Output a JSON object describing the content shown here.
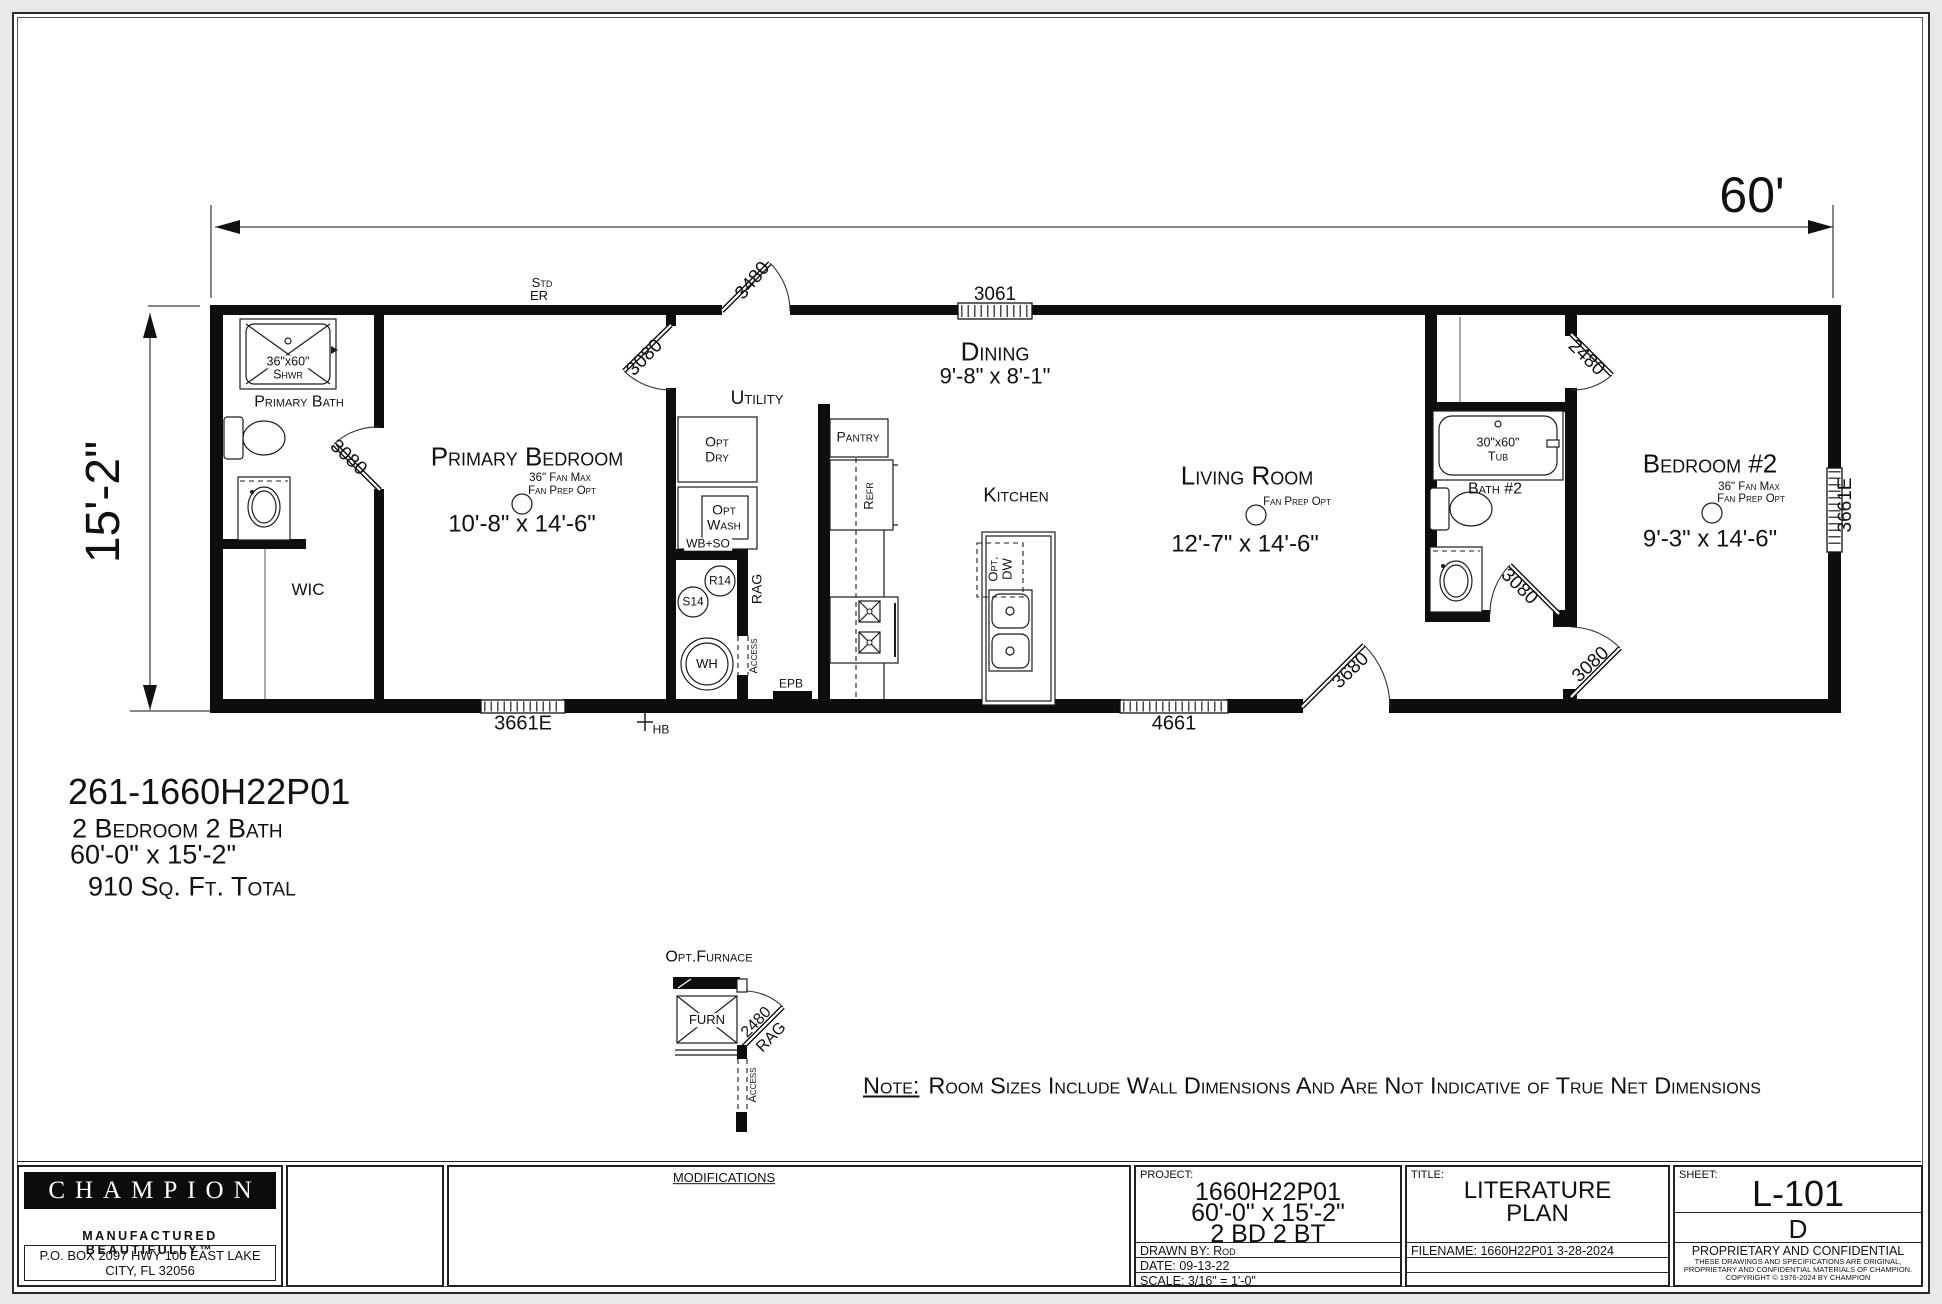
{
  "dimensions": {
    "width": "60'",
    "height": "15'-2\""
  },
  "plan": {
    "std": "Std",
    "er": "ER",
    "door_front": "3480",
    "window_dining": "3061",
    "dining": {
      "name": "Dining",
      "size": "9'-8\" x 8'-1\""
    },
    "utility": {
      "name": "Utility",
      "door": "3080",
      "opt": "Opt",
      "dry": "Dry",
      "wash": "Wash",
      "wb_so": "WB+SO",
      "r14": "R14",
      "s14": "S14",
      "wh": "WH",
      "rag": "RAG",
      "access": "Access",
      "epb": "EPB"
    },
    "kitchen": {
      "name": "Kitchen",
      "pantry": "Pantry",
      "refr": "Refr",
      "opt_dw1": "Opt.",
      "opt_dw2": "DW"
    },
    "living": {
      "name": "Living Room",
      "fan_prep": "Fan Prep Opt",
      "size": "12'-7\" x 14'-6\""
    },
    "primary_bedroom": {
      "name": "Primary Bedroom",
      "fan_max": "36\" Fan Max",
      "fan_prep": "Fan Prep Opt",
      "size": "10'-8\" x 14'-6\""
    },
    "primary_bath": {
      "name": "Primary Bath",
      "shower_size": "36\"x60\"",
      "shower": "Shwr",
      "door": "3080",
      "wic": "WIC"
    },
    "bath2": {
      "name": "Bath #2",
      "tub_size": "30\"x60\"",
      "tub": "Tub",
      "door": "3080",
      "closet_door": "2480"
    },
    "bedroom2": {
      "name": "Bedroom #2",
      "fan_max": "36\" Fan Max",
      "fan_prep": "Fan Prep Opt",
      "size": "9'-3\" x 14'-6\"",
      "door": "3080"
    },
    "window_bed1": "3661E",
    "hb": "HB",
    "window_living": "4661",
    "door_rear": "3680",
    "window_bed2": "3661E"
  },
  "furnace": {
    "title": "Opt.Furnace",
    "furn": "FURN",
    "door": "2480",
    "rag": "RAG",
    "access": "Access"
  },
  "info": {
    "model": "261-1660H22P01",
    "beds": "2 Bedroom 2 Bath",
    "size": "60'-0\" x 15'-2\"",
    "area": "910 Sq. Ft. Total"
  },
  "note": {
    "label": "Note:",
    "text": "Room Sizes Include Wall Dimensions And Are Not Indicative of True Net Dimensions"
  },
  "titleblock": {
    "brand": {
      "name": "CHAMPION",
      "tagline": "MANUFACTURED BEAUTIFULLY™",
      "address": "P.O. BOX 2097 HWY 100 EAST LAKE CITY, FL  32056"
    },
    "modifications": "MODIFICATIONS",
    "project": {
      "label": "PROJECT:",
      "line1": "1660H22P01",
      "line2": "60'-0\" x 15'-2\"",
      "line3": "2 BD 2 BT",
      "drawn_by": "DRAWN BY: Rod",
      "date": "DATE: 09-13-22",
      "scale": "SCALE: 3/16\" = 1'-0\""
    },
    "title": {
      "label": "TITLE:",
      "line1": "LITERATURE",
      "line2": "PLAN",
      "filename": "FILENAME: 1660H22P01 3-28-2024"
    },
    "sheet": {
      "label": "SHEET:",
      "number": "L-101",
      "revision": "D",
      "prop_title": "PROPRIETARY AND CONFIDENTIAL",
      "prop_line1": "THESE DRAWINGS AND SPECIFICATIONS ARE ORIGINAL,",
      "prop_line2": "PROPRIETARY AND CONFIDENTIAL MATERIALS OF CHAMPION.",
      "prop_line3": "COPYRIGHT © 1976-2024 BY CHAMPION"
    }
  }
}
